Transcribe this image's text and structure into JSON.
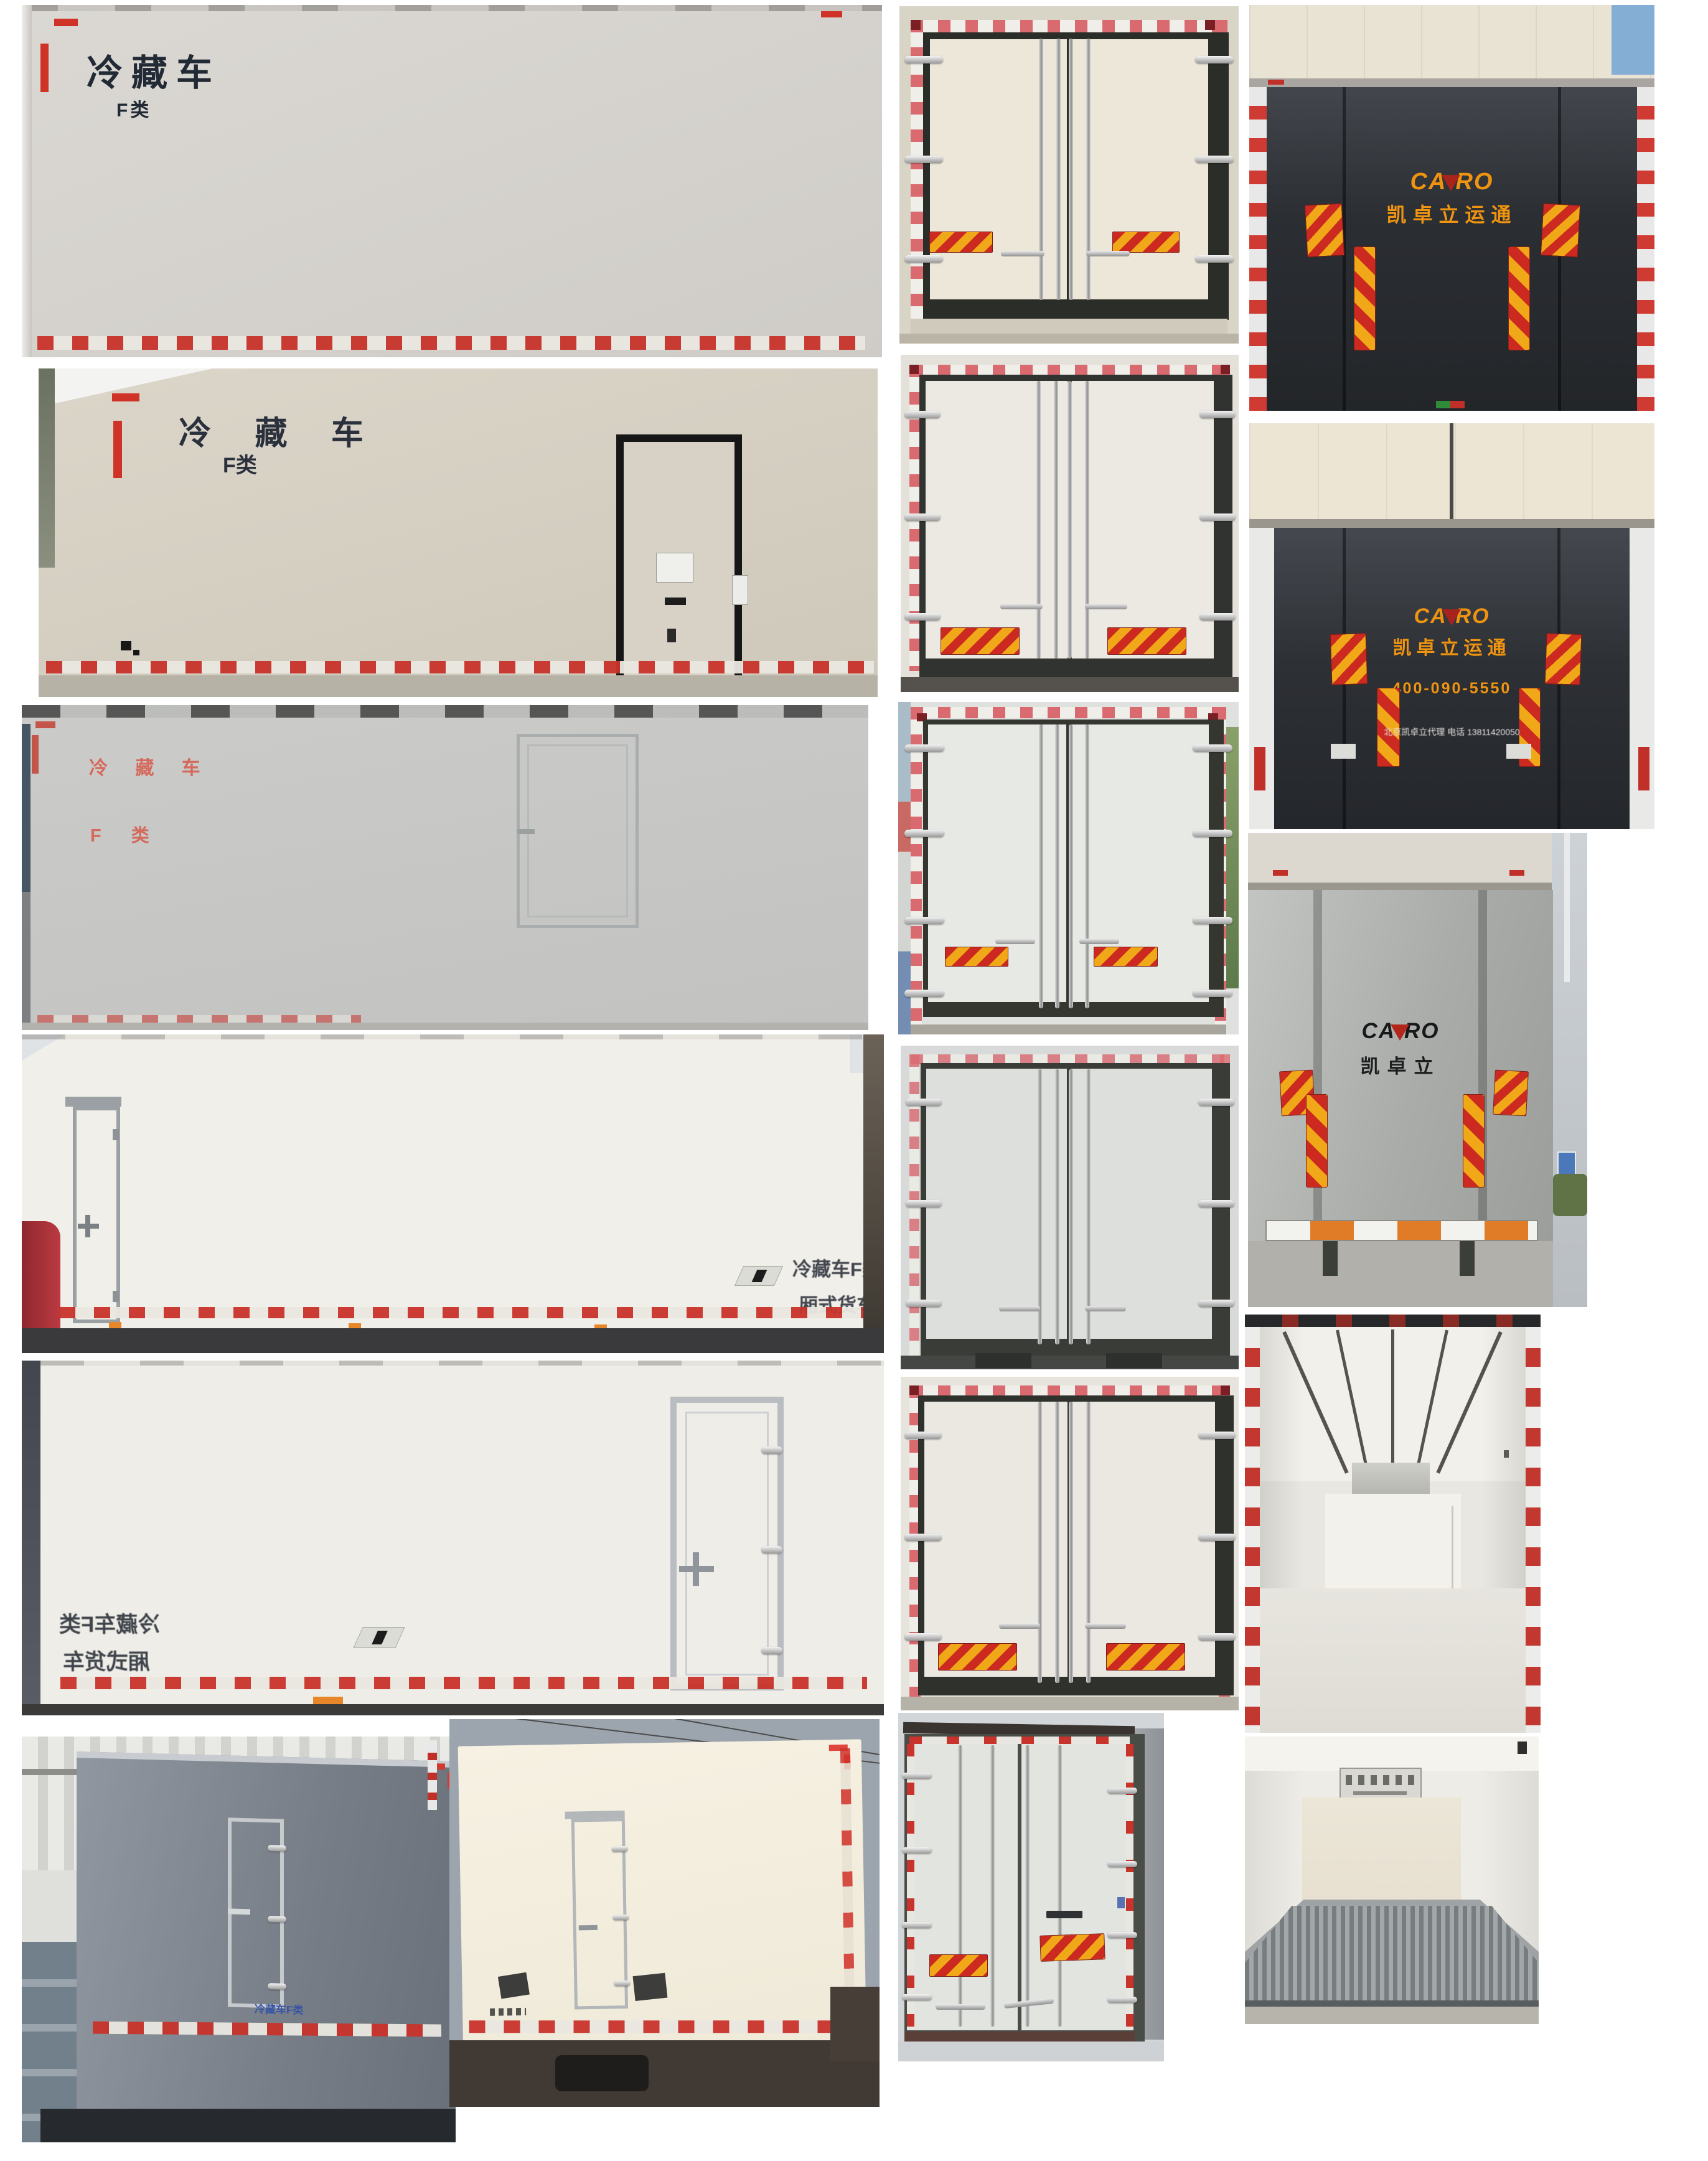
{
  "colors": {
    "chevron_red": "#cc2a20",
    "chevron_yellow": "#f0a818",
    "brand_orange": "#ef9410",
    "label_blue": "#3753a5",
    "label_red_text": "#d4695c",
    "dark_tail_lift": "#32363b",
    "reflective_red": "#c8332b"
  },
  "side_views": {
    "p1": {
      "line1": "冷藏车",
      "line2": "F类"
    },
    "p2": {
      "line1": "冷 藏 车",
      "line2": "F类"
    },
    "p3": {
      "line1": "冷 藏 车",
      "line2": "F 类"
    },
    "p4": {
      "line1": "冷藏车F类",
      "line2": "厢式货车"
    },
    "p5": {
      "line1": "冷藏车F类",
      "line2": "厢式货车"
    },
    "p6": {
      "label": "冷藏车F类"
    }
  },
  "tail_lifts": {
    "brand": {
      "part1": "CA",
      "part2": "RO",
      "full": "CAZRO"
    },
    "t1": {
      "subtitle": "凯卓立运通"
    },
    "t2": {
      "subtitle": "凯卓立运通",
      "phone": "400-090-5550",
      "contact": "北京凯卓立代理 电话 13811420050"
    },
    "t3": {
      "subtitle": "凯卓立"
    }
  }
}
